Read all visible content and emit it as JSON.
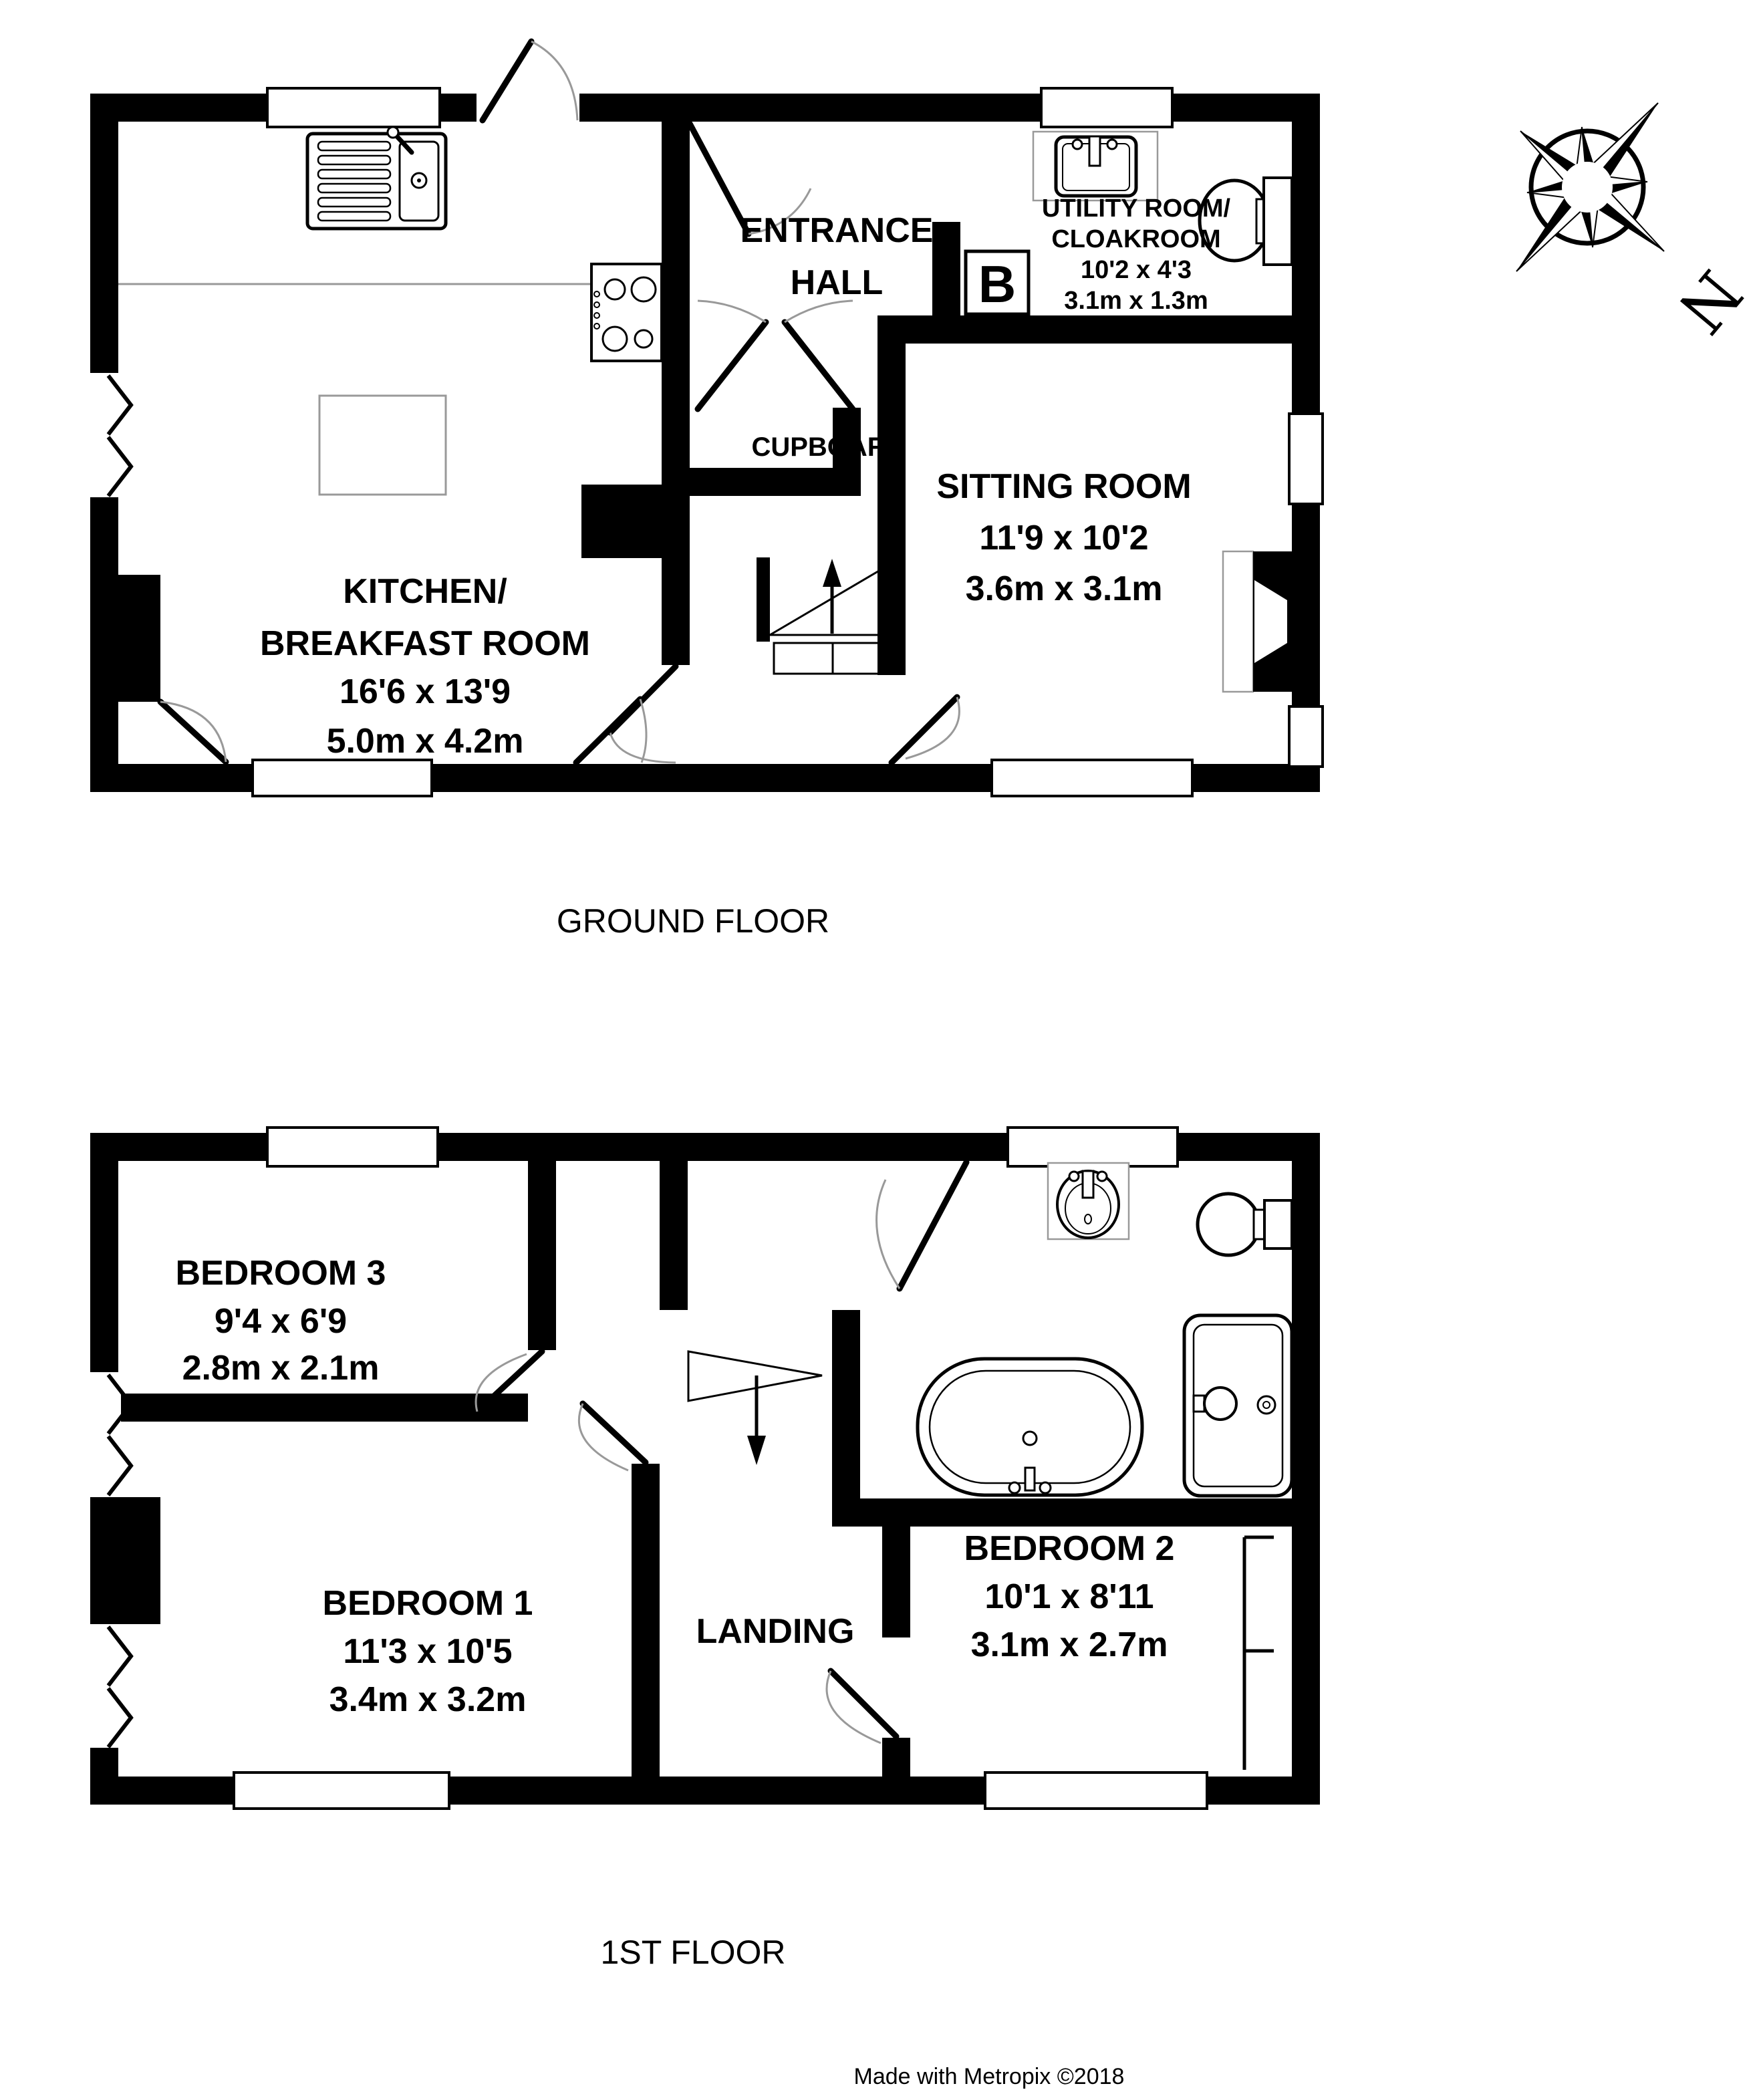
{
  "colors": {
    "wall": "#000000",
    "counter": "#999999",
    "background": "#ffffff"
  },
  "compass": {
    "north_label": "N"
  },
  "ground_floor": {
    "caption": "GROUND FLOOR",
    "rooms": {
      "kitchen": {
        "lines": [
          "KITCHEN/",
          "BREAKFAST ROOM",
          "16'6 x 13'9",
          "5.0m x 4.2m"
        ]
      },
      "entrance_hall": {
        "lines": [
          "ENTRANCE",
          "HALL"
        ]
      },
      "cupboard": {
        "label": "CUPBOARD"
      },
      "utility": {
        "lines": [
          "UTILITY ROOM/",
          "CLOAKROOM",
          "10'2 x 4'3",
          "3.1m x 1.3m"
        ]
      },
      "sitting": {
        "lines": [
          "SITTING ROOM",
          "11'9 x 10'2",
          "3.6m x 3.1m"
        ]
      },
      "boiler": {
        "label": "B"
      }
    }
  },
  "first_floor": {
    "caption": "1ST FLOOR",
    "rooms": {
      "bedroom3": {
        "lines": [
          "BEDROOM 3",
          "9'4 x 6'9",
          "2.8m x 2.1m"
        ]
      },
      "bedroom1": {
        "lines": [
          "BEDROOM 1",
          "11'3 x 10'5",
          "3.4m x 3.2m"
        ]
      },
      "bedroom2": {
        "lines": [
          "BEDROOM 2",
          "10'1 x 8'11",
          "3.1m x 2.7m"
        ]
      },
      "landing": {
        "label": "LANDING"
      }
    }
  },
  "footer": {
    "credit": "Made with Metropix ©2018"
  }
}
